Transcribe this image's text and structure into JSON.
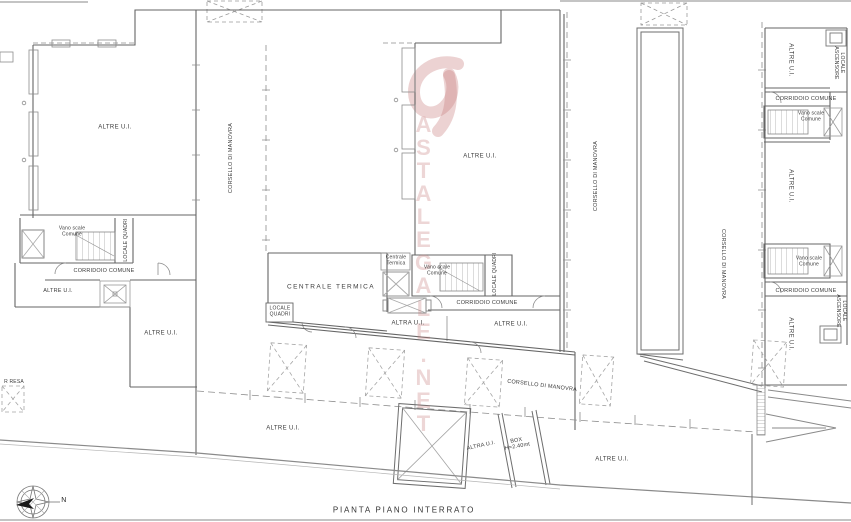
{
  "plan": {
    "title": "PIANTA PIANO INTERRATO",
    "compass_north": "N",
    "edge_label": "R RESA"
  },
  "watermark": {
    "text": "ASTALEGALE.NET",
    "color": "#c47676"
  },
  "labels": {
    "altre_ui": "ALTRE U.I.",
    "altra_ui": "ALTRA U.I.",
    "corsello_di_manovra": "CORSELLO DI MANOVRA",
    "corridoio_comune": "CORRIDOIO COMUNE",
    "vano_scale_comune": "Vano scale Comune",
    "locale_quadri": "LOCALE QUADRI",
    "locale_ascensore": "LOCALE ASCENSORE",
    "centrale_termica": "CENTRALE TERMICA",
    "centrale_termica_small": "Centrale Termica",
    "box": "BOX",
    "box_height": "H=2.40mt"
  }
}
